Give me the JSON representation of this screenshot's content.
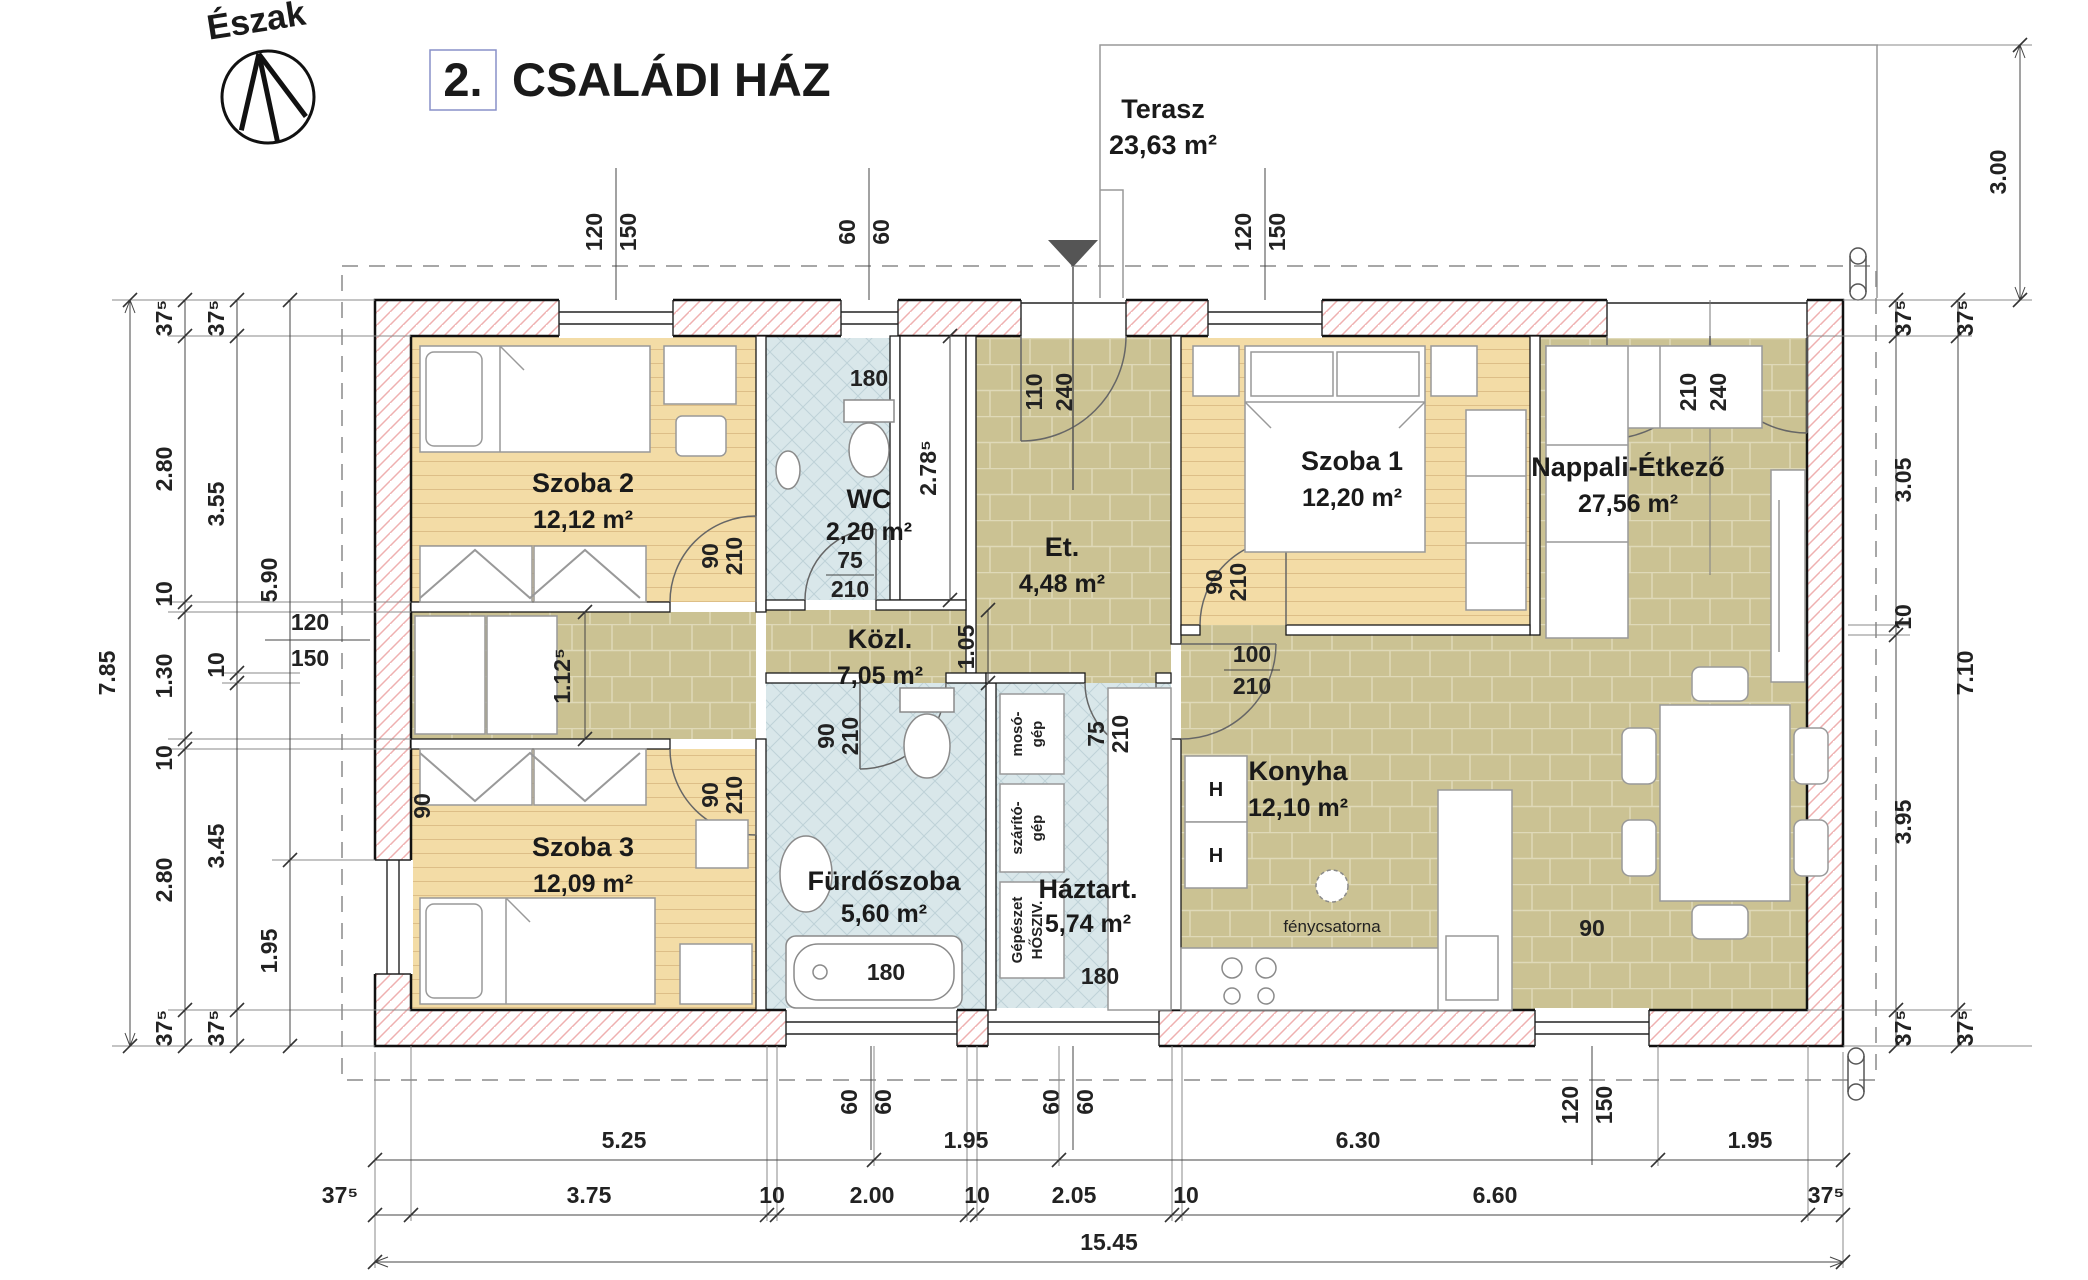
{
  "title": {
    "number": "2.",
    "text": "CSALÁDI HÁZ"
  },
  "north": {
    "label": "Észak"
  },
  "terrace": {
    "name": "Terasz",
    "area": "23,63 m²"
  },
  "rooms": {
    "szoba1": {
      "name": "Szoba 1",
      "area": "12,20 m²"
    },
    "szoba2": {
      "name": "Szoba 2",
      "area": "12,12 m²"
    },
    "szoba3": {
      "name": "Szoba 3",
      "area": "12,09 m²"
    },
    "wc": {
      "name": "WC",
      "area": "2,20 m²"
    },
    "et": {
      "name": "Et.",
      "area": "4,48 m²"
    },
    "kozl": {
      "name": "Közl.",
      "area": "7,05 m²"
    },
    "furdo": {
      "name": "Fürdőszoba",
      "area": "5,60 m²"
    },
    "haztart": {
      "name": "Háztart.",
      "area": "5,74 m²"
    },
    "konyha": {
      "name": "Konyha",
      "area": "12,10 m²"
    },
    "nappali": {
      "name": "Nappali-Étkező",
      "area": "27,56 m²"
    }
  },
  "openings": {
    "top_szoba2": [
      "120",
      "150"
    ],
    "top_wc": [
      "60",
      "60"
    ],
    "entry": [
      "110",
      "240"
    ],
    "top_szoba1": [
      "120",
      "150"
    ],
    "terrace_door": [
      "210",
      "240"
    ],
    "szoba2_door": [
      "90",
      "210"
    ],
    "szoba3_door": [
      "90",
      "210"
    ],
    "szoba1_door": [
      "90",
      "210"
    ],
    "wc_door": [
      "75",
      "210"
    ],
    "furdo_door": [
      "90",
      "210"
    ],
    "haztart_door": [
      "75",
      "210"
    ],
    "konyha_door": [
      "100",
      "210"
    ],
    "left_window": [
      "120",
      "150"
    ],
    "bottom_furdo": [
      "60",
      "60"
    ],
    "bottom_haztart": [
      "60",
      "60"
    ],
    "bottom_nappali": [
      "120",
      "150"
    ],
    "szoba3_sill": "90",
    "nappali_sill": "90",
    "wc_window": "180",
    "tub": "180",
    "haztart_window": "180"
  },
  "dims": {
    "left_total": "7.85",
    "left_chain2": [
      "37⁵",
      "2.80",
      "10",
      "1.30",
      "10",
      "2.80",
      "37⁵"
    ],
    "left_chain3": [
      "37⁵",
      "3.55",
      "10",
      "3.45",
      "37⁵"
    ],
    "left_chain4": [
      "5.90",
      "1.95"
    ],
    "right_chain1": [
      "37⁵",
      "3.05",
      "10",
      "3.95",
      "37⁵"
    ],
    "right_chain2": [
      "37⁵",
      "7.10",
      "37⁵"
    ],
    "terrace_depth": "3.00",
    "bottom_row1": [
      "5.25",
      "1.95",
      "6.30",
      "1.95"
    ],
    "bottom_row2": [
      "37⁵",
      "3.75",
      "10",
      "2.00",
      "10",
      "2.05",
      "10",
      "6.60",
      "37⁵"
    ],
    "bottom_total": "15.45",
    "wc_depth": "2.78⁵",
    "kozl_w_left": "1.12⁵",
    "kozl_w_right": "1.05"
  },
  "fixtures": {
    "light_tunnel": "fénycsatorna",
    "washer": [
      "mosó-",
      "gép"
    ],
    "dryer": [
      "szárító-",
      "gép"
    ],
    "mech": [
      "Gépészet",
      "HŐSZIV."
    ],
    "hob": "H"
  }
}
